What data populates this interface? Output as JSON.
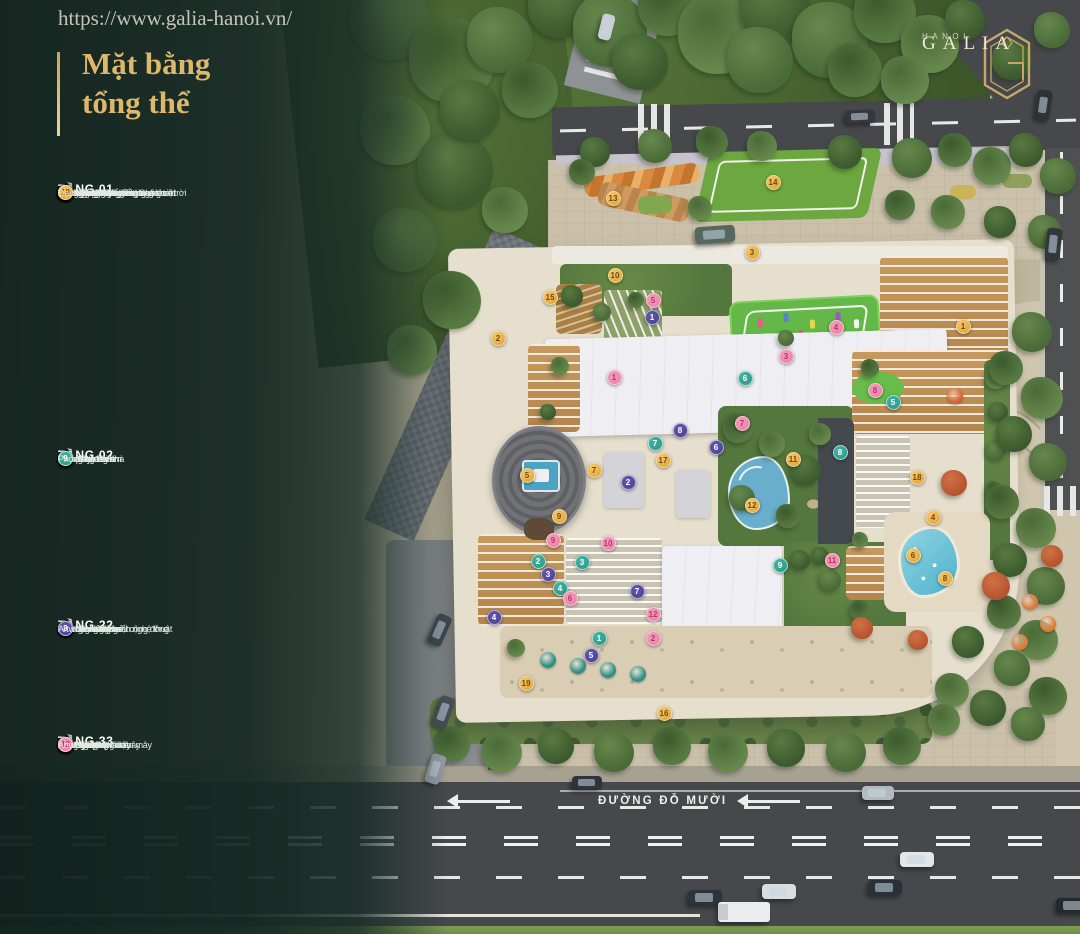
{
  "watermark": {
    "url_text": "https://www.galia-hanoi.vn/"
  },
  "title": {
    "line1": "Mặt bằng",
    "line2": "tổng thể"
  },
  "logo": {
    "brand": "GALIA",
    "city": "HANOI"
  },
  "map": {
    "road_label": "ĐƯỜNG ĐỖ MƯỜI"
  },
  "colors": {
    "accent_gold": "#D9B66C",
    "panel_green": "#14281F"
  },
  "sections": [
    {
      "id": "tang-01",
      "title": "TẦNG 01",
      "marker_color": "#DE9E33",
      "marker_light": "#F5C96E",
      "marker_ring": "#F4D894",
      "number_color": "#6F4A0E",
      "items": [
        "Sảnh đón thương mại",
        "Sảnh đón cư dân",
        "Quảng trường nước nghệ thuật",
        "Khu tiểu cảnh nước",
        "Sân khấu nhạc nước Galia",
        "Sân khấu ngoài trời",
        "Chòi nghỉ tán cây",
        "Không gian nhà hàng ngoài trời",
        "Tường cây & tiểu cảnh",
        "Cổng an ninh",
        "Vườn Zen thông tầng",
        "Hồ cá Koi",
        "Vườn trẻ & Khu thể thao ngoài trời",
        "Artwork nghệ thuật tương tác",
        "Lối đi ưu tiên",
        "Bậc thang",
        "Đại sảnh cư dân",
        "Co-working Space",
        "Đại sảnh thương mại"
      ]
    },
    {
      "id": "tang-02",
      "title": "TẦNG 02",
      "marker_color": "#2E9486",
      "marker_light": "#41B3A2",
      "marker_ring": "#9FE2D8",
      "number_color": "#FFFFFF",
      "items": [
        "Bể bơi người lớn",
        "Bể bơi trẻ em",
        "Khu thay đồ nữ",
        "Khu thay đồ nam",
        "Kid's Club",
        "Rạp phim Galia",
        "Galia Fitness",
        "Golf 3D trong nhà",
        "Phòng học"
      ]
    },
    {
      "id": "tang-22",
      "title": "TẦNG 22",
      "marker_color": "#4A4190",
      "marker_light": "#6056AC",
      "marker_ring": "#B4ADE0",
      "number_color": "#FFFFFF",
      "items": [
        "Sân chơi lửng lơ",
        "Khu board game",
        "Khu Co-working",
        "Khu đọc sách mở",
        "Không gian kết nối cộng đồng",
        "Đài thiên văn",
        "Tiểu cảnh cây xanh nghệ thuật",
        "Artwork nghệ thuật"
      ]
    },
    {
      "id": "tang-33",
      "title": "TẦNG 33",
      "marker_color": "#EC7FA6",
      "marker_light": "#F49AB9",
      "marker_ring": "#F9C6D8",
      "number_color": "#B03B66",
      "items": [
        "Sky Gym",
        "Sky Camping",
        "Đường dạo chân mây",
        "Sky Yoga",
        "Sky Golf",
        "Sky Bar",
        "Đài thiên văn",
        "Võng trời thư giãn",
        "Vườn ẩm thực chân mây",
        "Rooftop BBQ",
        "Vườn cờ chân mây",
        "Artwork nghệ thuật"
      ]
    }
  ],
  "map_markers": [
    {
      "g": 0,
      "n": 1,
      "x": 963,
      "y": 326
    },
    {
      "g": 0,
      "n": 2,
      "x": 498,
      "y": 338
    },
    {
      "g": 0,
      "n": 3,
      "x": 752,
      "y": 252
    },
    {
      "g": 0,
      "n": 4,
      "x": 933,
      "y": 517
    },
    {
      "g": 0,
      "n": 5,
      "x": 527,
      "y": 475
    },
    {
      "g": 0,
      "n": 6,
      "x": 913,
      "y": 555
    },
    {
      "g": 0,
      "n": 7,
      "x": 594,
      "y": 470
    },
    {
      "g": 0,
      "n": 8,
      "x": 945,
      "y": 578
    },
    {
      "g": 0,
      "n": 9,
      "x": 559,
      "y": 516
    },
    {
      "g": 0,
      "n": 10,
      "x": 615,
      "y": 275
    },
    {
      "g": 0,
      "n": 11,
      "x": 793,
      "y": 459
    },
    {
      "g": 0,
      "n": 12,
      "x": 752,
      "y": 505
    },
    {
      "g": 0,
      "n": 13,
      "x": 613,
      "y": 198
    },
    {
      "g": 0,
      "n": 14,
      "x": 773,
      "y": 182
    },
    {
      "g": 0,
      "n": 15,
      "x": 550,
      "y": 297
    },
    {
      "g": 0,
      "n": 16,
      "x": 664,
      "y": 713
    },
    {
      "g": 0,
      "n": 17,
      "x": 663,
      "y": 460
    },
    {
      "g": 0,
      "n": 18,
      "x": 917,
      "y": 477
    },
    {
      "g": 0,
      "n": 19,
      "x": 526,
      "y": 683
    },
    {
      "g": 1,
      "n": 1,
      "x": 599,
      "y": 638
    },
    {
      "g": 1,
      "n": 2,
      "x": 538,
      "y": 561
    },
    {
      "g": 1,
      "n": 3,
      "x": 582,
      "y": 562
    },
    {
      "g": 1,
      "n": 4,
      "x": 560,
      "y": 588
    },
    {
      "g": 1,
      "n": 5,
      "x": 893,
      "y": 402
    },
    {
      "g": 1,
      "n": 6,
      "x": 745,
      "y": 378
    },
    {
      "g": 1,
      "n": 7,
      "x": 655,
      "y": 443
    },
    {
      "g": 1,
      "n": 8,
      "x": 840,
      "y": 452
    },
    {
      "g": 1,
      "n": 9,
      "x": 780,
      "y": 565
    },
    {
      "g": 2,
      "n": 1,
      "x": 652,
      "y": 317
    },
    {
      "g": 2,
      "n": 2,
      "x": 628,
      "y": 482
    },
    {
      "g": 2,
      "n": 3,
      "x": 548,
      "y": 574
    },
    {
      "g": 2,
      "n": 4,
      "x": 494,
      "y": 617
    },
    {
      "g": 2,
      "n": 5,
      "x": 591,
      "y": 655
    },
    {
      "g": 2,
      "n": 6,
      "x": 716,
      "y": 447
    },
    {
      "g": 2,
      "n": 7,
      "x": 637,
      "y": 591
    },
    {
      "g": 2,
      "n": 8,
      "x": 680,
      "y": 430
    },
    {
      "g": 3,
      "n": 1,
      "x": 614,
      "y": 377
    },
    {
      "g": 3,
      "n": 2,
      "x": 653,
      "y": 638
    },
    {
      "g": 3,
      "n": 3,
      "x": 786,
      "y": 356
    },
    {
      "g": 3,
      "n": 4,
      "x": 836,
      "y": 327
    },
    {
      "g": 3,
      "n": 5,
      "x": 653,
      "y": 300
    },
    {
      "g": 3,
      "n": 6,
      "x": 570,
      "y": 598
    },
    {
      "g": 3,
      "n": 7,
      "x": 742,
      "y": 423
    },
    {
      "g": 3,
      "n": 8,
      "x": 875,
      "y": 390
    },
    {
      "g": 3,
      "n": 9,
      "x": 553,
      "y": 540
    },
    {
      "g": 3,
      "n": 10,
      "x": 608,
      "y": 543
    },
    {
      "g": 3,
      "n": 11,
      "x": 832,
      "y": 560
    },
    {
      "g": 3,
      "n": 12,
      "x": 653,
      "y": 614
    }
  ]
}
